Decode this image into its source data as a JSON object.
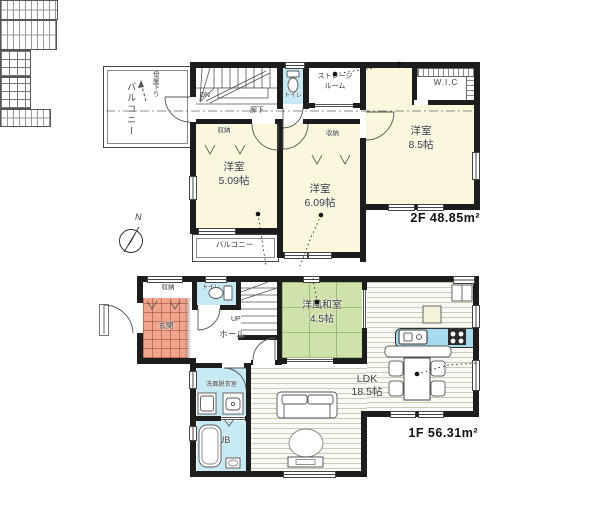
{
  "compass": {
    "north": "N"
  },
  "floor2": {
    "area": "2F 48.85m²",
    "balcony_left": "バルコニー",
    "roof_slope_note": "母屋下り",
    "stairs": "DN",
    "toilet": "トイレ",
    "storage_room_line1": "ストレージ",
    "storage_room_line2": "ルーム",
    "corridor": "廊下",
    "closet_a": "収納",
    "closet_b": "収納",
    "wic": "W.I.C",
    "bedroom_main_name": "洋室",
    "bedroom_main_size": "8.5帖",
    "bedroom_a_name": "洋室",
    "bedroom_a_size": "5.09帖",
    "bedroom_b_name": "洋室",
    "bedroom_b_size": "6.09帖",
    "balcony_bottom": "バルコニー"
  },
  "floor1": {
    "area": "1F 56.31m²",
    "closet": "収納",
    "toilet": "トイレ",
    "entrance": "玄関",
    "hall": "ホール",
    "stairs": "UP",
    "washroom": "洗面脱衣室",
    "bath": "UB",
    "tatami_room_name": "洋風和室",
    "tatami_room_size": "4.5帖",
    "ldk_name": "LDK",
    "ldk_size": "18.5帖"
  },
  "colors": {
    "wall": "#1d1d1d",
    "western_room": "#faf7dd",
    "wet_area": "#c7e9f4",
    "tatami": "#cfe2ab",
    "entrance_tile": "#efa48d",
    "kitchen_counter": "#a6dbef"
  }
}
